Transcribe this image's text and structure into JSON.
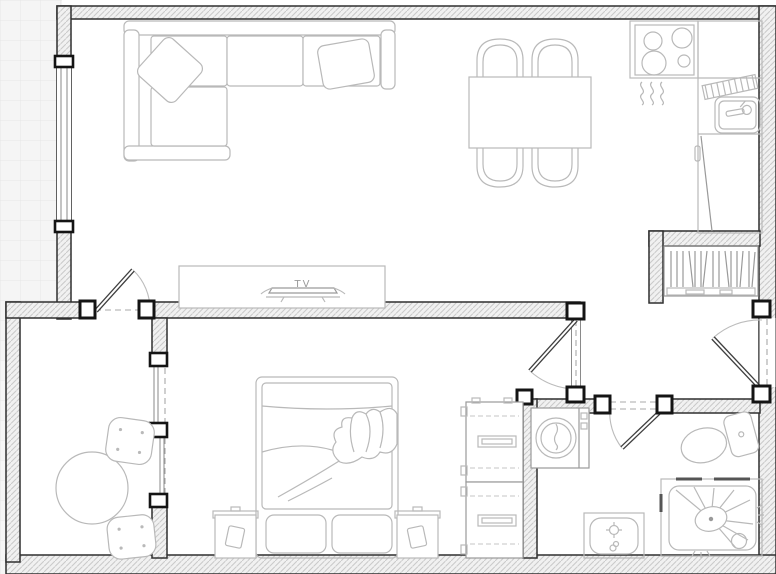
{
  "canvas": {
    "width": 776,
    "height": 574
  },
  "labels": {
    "tv": "TV"
  },
  "colors": {
    "canvas": "#ffffff",
    "grid_bg": "#f5f5f5",
    "grid_line": "#e6e6e6",
    "wall_line": "#2f2f2f",
    "hatch_bg": "#f1f1f1",
    "hatch_line": "#c9c9c9",
    "furniture_line": "#b9b9b9",
    "furniture_dark": "#9a9a9a",
    "door_leaf": "#3f3f3f",
    "swing_arc": "#bcbcbc",
    "dashed_line": "#a8a8a8",
    "jamb": "#141414",
    "tv_text": "#9b9b9b"
  },
  "objects": {
    "living_room": [
      "sectional-sofa",
      "throw-pillow-left",
      "throw-pillow-right",
      "tv-console",
      "tv"
    ],
    "dining_area": [
      "dining-table",
      "dining-chair-x4"
    ],
    "kitchen": [
      "cooktop-4-burner",
      "heat-waves",
      "counter",
      "dish-rack",
      "kitchen-sink",
      "refrigerator"
    ],
    "hallway": [
      "bookshelf",
      "entry-door"
    ],
    "balcony": [
      "round-table",
      "stool-x2",
      "sliding-window",
      "balcony-door"
    ],
    "bedroom": [
      "double-bed",
      "pillow-x2",
      "blanket",
      "nightstand-x2",
      "wardrobe-x2",
      "bedroom-door"
    ],
    "bathroom": [
      "washing-machine",
      "bathroom-sink",
      "toilet",
      "shower",
      "bathroom-door"
    ]
  }
}
